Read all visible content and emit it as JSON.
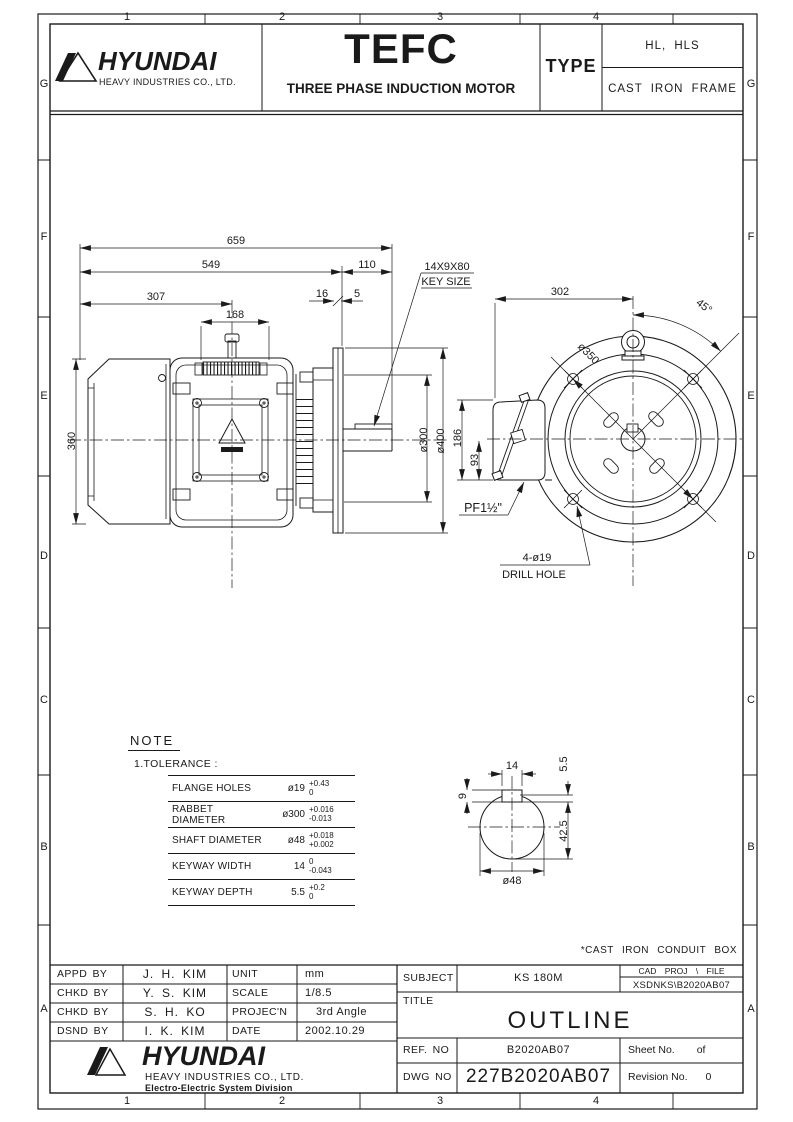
{
  "border": {
    "cols": [
      "1",
      "2",
      "3",
      "4"
    ],
    "rows": [
      "G",
      "F",
      "E",
      "D",
      "C",
      "B",
      "A"
    ]
  },
  "header": {
    "logo": {
      "brand": "HYUNDAI",
      "sub": "HEAVY INDUSTRIES CO., LTD."
    },
    "product": {
      "title": "TEFC",
      "subtitle": "THREE PHASE INDUCTION MOTOR"
    },
    "type_label": "TYPE",
    "type_value1": "HL, HLS",
    "type_value2": "CAST IRON FRAME"
  },
  "dims": {
    "l659": "659",
    "l549": "549",
    "l307": "307",
    "l168": "168",
    "l110": "110",
    "l16": "16",
    "l5": "5",
    "l360": "360",
    "d300": "ø300",
    "d400": "ø400",
    "l186": "186",
    "l93": "93",
    "l302": "302",
    "a45": "45°",
    "d350": "ø350",
    "key1": "14X9X80",
    "key2": "KEY SIZE",
    "drill1": "4-ø19",
    "drill2": "DRILL HOLE",
    "pf": "PF1½\""
  },
  "shaft_detail": {
    "w14": "14",
    "d55": "5.5",
    "d9": "9",
    "d425": "42.5",
    "dia48": "ø48"
  },
  "note": {
    "title": "NOTE",
    "item": "1.TOLERANCE :",
    "rows": [
      {
        "name": "FLANGE HOLES",
        "value": "ø19",
        "upper": "+0.43",
        "lower": "0"
      },
      {
        "name": "RABBET DIAMETER",
        "value": "ø300",
        "upper": "+0.016",
        "lower": "-0.013"
      },
      {
        "name": "SHAFT DIAMETER",
        "value": "ø48",
        "upper": "+0.018",
        "lower": "+0.002"
      },
      {
        "name": "KEYWAY WIDTH",
        "value": "14",
        "upper": "0",
        "lower": "-0.043"
      },
      {
        "name": "KEYWAY DEPTH",
        "value": "5.5",
        "upper": "+0.2",
        "lower": "0"
      }
    ]
  },
  "conduit_note": "*CAST IRON CONDUIT BOX",
  "titleblock": {
    "approvals": [
      {
        "label": "APPD BY",
        "name": "J. H. KIM"
      },
      {
        "label": "CHKD BY",
        "name": "Y. S. KIM"
      },
      {
        "label": "CHKD BY",
        "name": "S. H. KO"
      },
      {
        "label": "DSND BY",
        "name": "I. K. KIM"
      }
    ],
    "meta": [
      {
        "label": "UNIT",
        "value": "mm"
      },
      {
        "label": "SCALE",
        "value": "1/8.5"
      },
      {
        "label": "PROJEC'N",
        "value": "3rd Angle"
      },
      {
        "label": "DATE",
        "value": "2002.10.29"
      }
    ],
    "subject_label": "SUBJECT",
    "subject": "KS 180M",
    "cad_header": "CAD PROJ   \\ FILE",
    "cad_file": "XSDNKS\\B2020AB07",
    "title_label": "TITLE",
    "title": "OUTLINE",
    "ref_label": "REF. NO",
    "ref": "B2020AB07",
    "sheet_label": "Sheet No.",
    "sheet_of": "of",
    "dwg_label": "DWG NO",
    "dwg": "227B2020AB07",
    "rev_label": "Revision No.",
    "rev_value": "0",
    "logo": {
      "brand": "HYUNDAI",
      "sub": "HEAVY INDUSTRIES CO., LTD.",
      "division": "Electro-Electric System Division"
    }
  }
}
